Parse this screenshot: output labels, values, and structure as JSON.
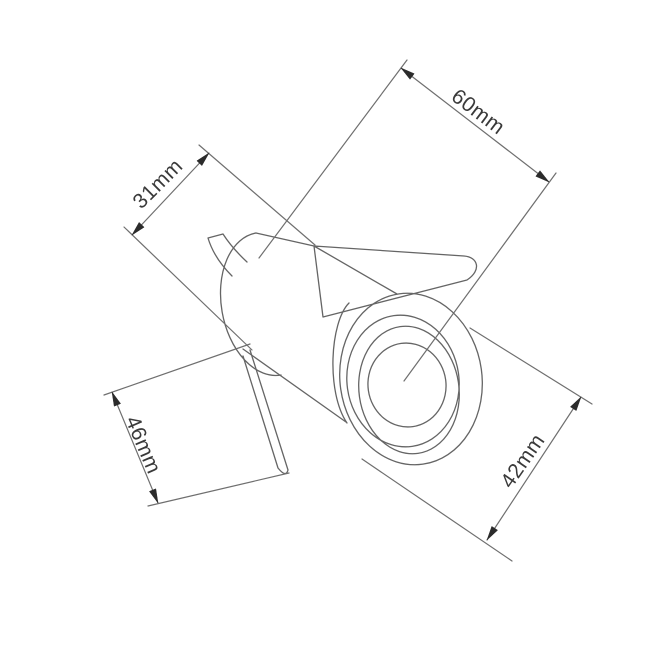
{
  "page": {
    "background_color": "#ffffff"
  },
  "drawing": {
    "kind": "technical dimension line drawing",
    "subject": "recessed cylindrical light fitting with spring clips",
    "unit": "mm",
    "line_color": "#6f6f6f",
    "arrow_color": "#2b2b2b",
    "text_color": "#3a3a3a",
    "dimensions": [
      {
        "label": "60mm",
        "value": 60,
        "location": "top-right, parallel to fixture axis"
      },
      {
        "label": "31mm",
        "value": 31,
        "location": "upper-left, across rear body"
      },
      {
        "label": "46mm",
        "value": 46,
        "location": "lower-left, clip to body span"
      },
      {
        "label": "42mm",
        "value": 42,
        "location": "lower-right, across front bezel"
      }
    ]
  }
}
